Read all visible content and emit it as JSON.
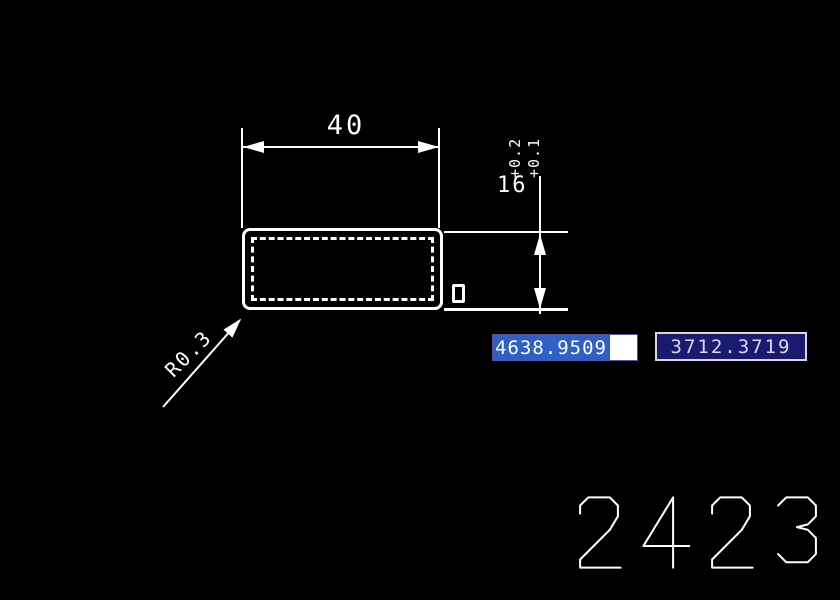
{
  "canvas": {
    "background": "#000000",
    "line_color": "#ffffff"
  },
  "drawing": {
    "width_dimension": {
      "value": "40"
    },
    "height_dimension": {
      "value": "16",
      "tolerance_upper": "+0.2",
      "tolerance_lower": "+0.1"
    },
    "leader": {
      "label": "R0.3"
    },
    "part_number": "2423"
  },
  "coordinate_inputs": {
    "x_field": {
      "value": "4638.9509",
      "state": "selected",
      "selection_color": "#3160c4",
      "background": "#ffffff"
    },
    "y_field": {
      "value": "3712.3719",
      "background": "#1a1a70",
      "text_color": "#d8d8e8"
    }
  }
}
